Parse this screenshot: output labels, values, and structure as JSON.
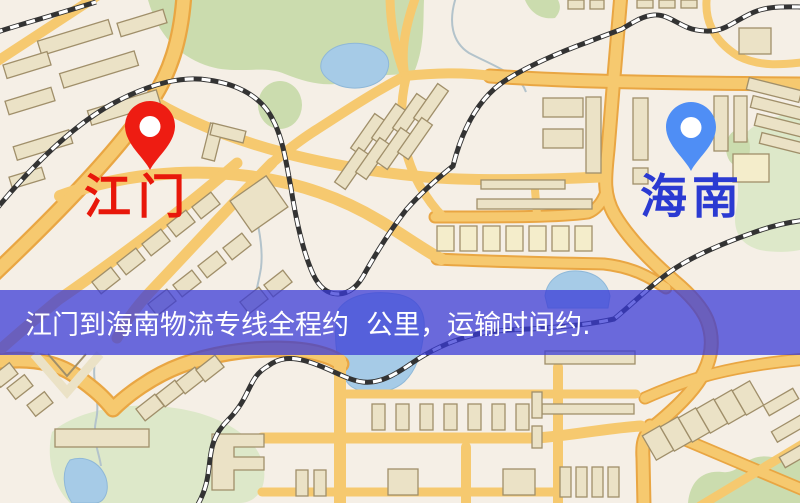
{
  "map": {
    "origin": {
      "name": "江门"
    },
    "destination": {
      "name": "海南"
    },
    "banner": {
      "text": "江门到海南物流专线全程约  公里，运输时间约."
    }
  },
  "colors": {
    "map_bg": "#f5efe6",
    "road_fill": "#f6c96f",
    "road_casing": "#e9a643",
    "building_fill": "#ebe2c6",
    "building_pale": "#f4edcb",
    "building_stroke": "#a08f6a",
    "green": "#cbdcae",
    "green_light": "#dde8c9",
    "water": "#a6cbe7",
    "water_edge": "#8fb8d8",
    "stream": "#b3c3cb",
    "railway_dark": "#333333",
    "banner_bg": "rgba(56,58,214,0.74)",
    "banner_text": "#ffffff",
    "pin_red": "#ee1c12",
    "pin_blue": "#4f8ef5",
    "label_red": "#e8170a",
    "label_blue": "#2b3ad2"
  }
}
